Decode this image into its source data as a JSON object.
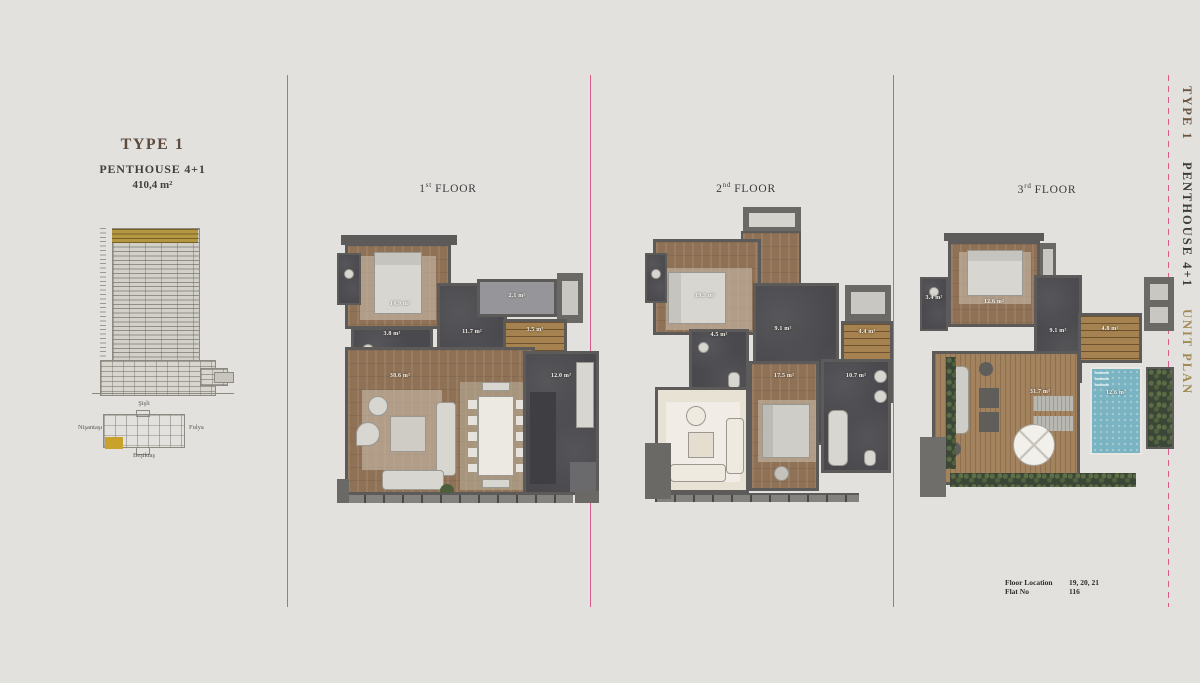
{
  "page": {
    "bg_color": "#e3e1de",
    "accent_pink": "#db5c8c",
    "highlight_gold": "#b39743",
    "pool_blue": "#7ab3c2"
  },
  "left_panel": {
    "type_title": "TYPE 1",
    "subtitle": "PENTHOUSE 4+1",
    "total_area": "410,4 m²",
    "site_plan": {
      "north": "Şişli",
      "west": "Nişantaşı",
      "east": "Fulya",
      "south": "Beşiktaş"
    }
  },
  "floors": [
    {
      "title": {
        "num": "1",
        "sup": "st",
        "word": "FLOOR"
      },
      "rooms": {
        "bedroom": "14.9 m²",
        "balcony": "2.1 m²",
        "bathroom": "3.8 m²",
        "hall": "11.7 m²",
        "stairs": "3.5 m²",
        "living": "38.6 m²",
        "kitchen": "12.0 m²"
      }
    },
    {
      "title": {
        "num": "2",
        "sup": "nd",
        "word": "FLOOR"
      },
      "rooms": {
        "bedroom": "19.3 m²",
        "bathroom": "4.5 m²",
        "hall": "9.1 m²",
        "stairs": "4.4 m²",
        "bedroom2": "17.5 m²",
        "bathroom2": "10.7 m²"
      }
    },
    {
      "title": {
        "num": "3",
        "sup": "rd",
        "word": "FLOOR"
      },
      "rooms": {
        "bathroom": "3.4 m²",
        "bedroom": "12.6 m²",
        "hall": "9.1 m²",
        "stairs": "4.8 m²",
        "terrace": "31.7 m²",
        "pool": "12.6 m²"
      }
    }
  ],
  "side_title": {
    "type": "TYPE 1",
    "name": "PENTHOUSE 4+1",
    "suffix": "UNIT PLAN"
  },
  "footer": {
    "floor_location_label": "Floor Location",
    "floor_location_value": "19, 20, 21",
    "flat_no_label": "Flat No",
    "flat_no_value": "116"
  }
}
